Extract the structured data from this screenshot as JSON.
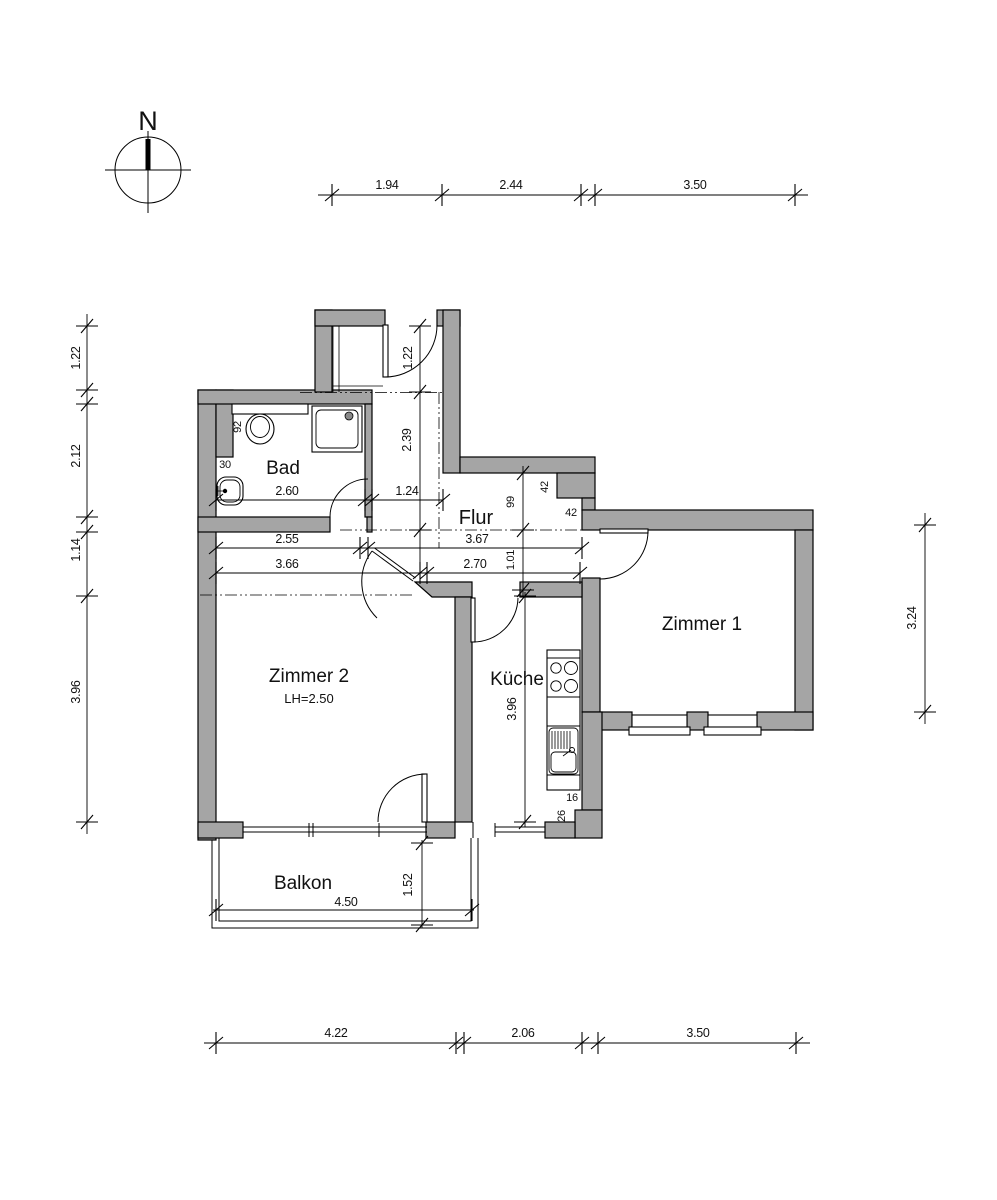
{
  "compass": {
    "label": "N"
  },
  "rooms": {
    "bad": "Bad",
    "flur": "Flur",
    "zimmer1": "Zimmer 1",
    "zimmer2": "Zimmer 2",
    "zimmer2_height": "LH=2.50",
    "kueche": "Küche",
    "balkon": "Balkon"
  },
  "dims": {
    "top": [
      "1.94",
      "2.44",
      "3.50"
    ],
    "bottom": [
      "4.22",
      "2.06",
      "3.50"
    ],
    "left": [
      "1.22",
      "2.12",
      "1.14",
      "3.96"
    ],
    "right": [
      "3.24"
    ],
    "bad": {
      "width": "2.60",
      "niche": "30",
      "fixture": "92"
    },
    "flur": {
      "entry": "1.22",
      "corridor": "2.39",
      "corridor_w": "1.24",
      "seg1": "2.55",
      "seg2": "3.67",
      "seg3": "3.66",
      "seg4": "2.70",
      "h1": "99",
      "h2": "1.01",
      "step1": "42",
      "step2": "42"
    },
    "kueche": {
      "depth": "3.96",
      "step1": "16",
      "step2": "26"
    },
    "balkon": {
      "width": "4.50",
      "depth": "1.52"
    }
  },
  "colors": {
    "wall": "#a5a5a5",
    "line": "#000000",
    "text": "#111111",
    "background": "#ffffff"
  }
}
